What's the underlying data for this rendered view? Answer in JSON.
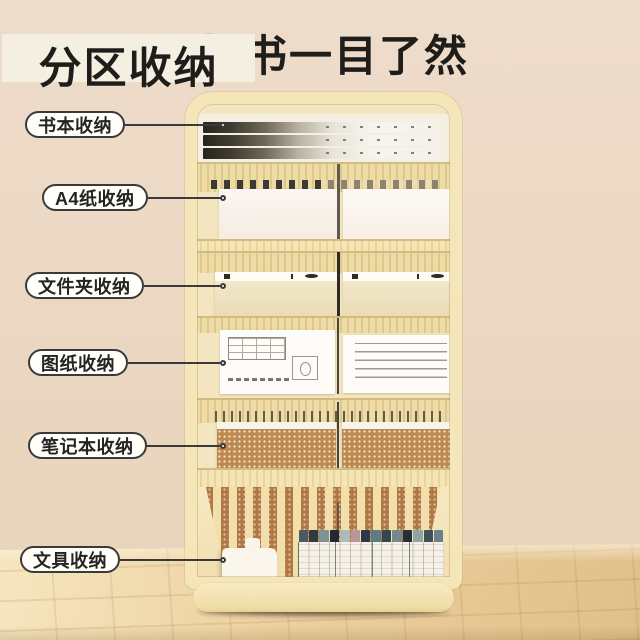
{
  "title": {
    "left": "分区收纳",
    "right": "找书一目了然"
  },
  "annotations": {
    "items": [
      {
        "label": "书本收纳"
      },
      {
        "label": "A4纸收纳"
      },
      {
        "label": "文件夹收纳"
      },
      {
        "label": "图纸收纳"
      },
      {
        "label": "笔记本收纳"
      },
      {
        "label": "文具收纳"
      }
    ]
  },
  "colors": {
    "wall": "#eedccb",
    "wall2": "#ebd7c1",
    "wall3": "#e8d3bb",
    "floor": "#ecd09f",
    "floorLight": "#f6e6c0",
    "floorDark": "#e0c08a",
    "cream": "#f5e6ba",
    "titleColor": "#1f1d1a",
    "line": "#3a3a3a",
    "notebook": "#bd8950",
    "brownBack": "#b07747"
  },
  "stationery": {
    "marker_cap_colors": [
      "#4a5a60",
      "#303b40",
      "#7b9597",
      "#23292e",
      "#a8bcbc",
      "#b9969a",
      "#2b3a46",
      "#5d7b84",
      "#35474d",
      "#75888f",
      "#262f36",
      "#90a5a6",
      "#414f56",
      "#69818a"
    ]
  }
}
